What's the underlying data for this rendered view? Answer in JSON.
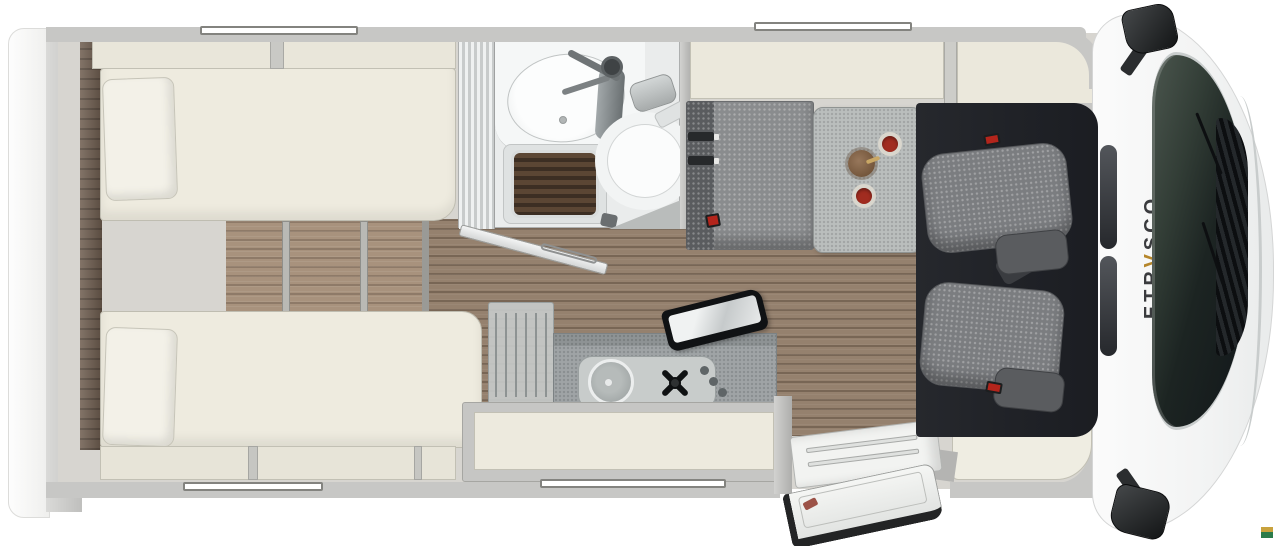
{
  "scene": {
    "type": "motorhome-floorplan-top-view",
    "brand_logo": {
      "pre": "ETR",
      "accent": "V",
      "post": "SCO"
    },
    "logo_colors": {
      "text": "#3a3b3e",
      "accent": "#b5862b"
    },
    "badge": {
      "top_color": "#c8a23d",
      "bottom_color": "#2b7b4a"
    },
    "palette": {
      "body_wall": "#c7c7c5",
      "interior": "#d7d5d0",
      "furniture_cream": "#edeade",
      "bed": "#eeebdf",
      "wood_floor": "#95816e",
      "step_wood": "#a8927d",
      "headboard_wood": "#6e5d4f",
      "bench_seat": "#8a8c8e",
      "bench_back": "#5a5c5f",
      "table": "#babebd",
      "counter": "#9fa4a6",
      "cab_interior": "#1f2126",
      "cab_seat": "#7b7d80",
      "windshield": "#1c2422",
      "cup_red": "#a12c20",
      "bowl_wood": "#7d5f41",
      "grate_wood": "#4c3a2d",
      "shower_door": "#cdd0d0"
    },
    "legend": [
      "rear-garage",
      "wardrobe-panel",
      "single-bed-top",
      "single-bed-bottom",
      "steps-between-beds",
      "overhead-lockers",
      "bathroom",
      "washbasin",
      "faucet",
      "shower-grate",
      "toilet",
      "toilet-paper-roll",
      "bathroom-door-open",
      "kitchen-dish-rack",
      "kitchen-counter",
      "kitchen-sink",
      "gas-burner",
      "burner-knobs",
      "glass-lid-open",
      "kitchen-sideboard",
      "dinette-bench",
      "seatbelts",
      "dinette-table",
      "cups",
      "wooden-bowl",
      "entry-step",
      "entry-door-open",
      "cab-interior",
      "passenger-seat",
      "driver-seat",
      "windshield",
      "wiper-cowl",
      "side-mirror-top",
      "side-mirror-bottom"
    ]
  }
}
